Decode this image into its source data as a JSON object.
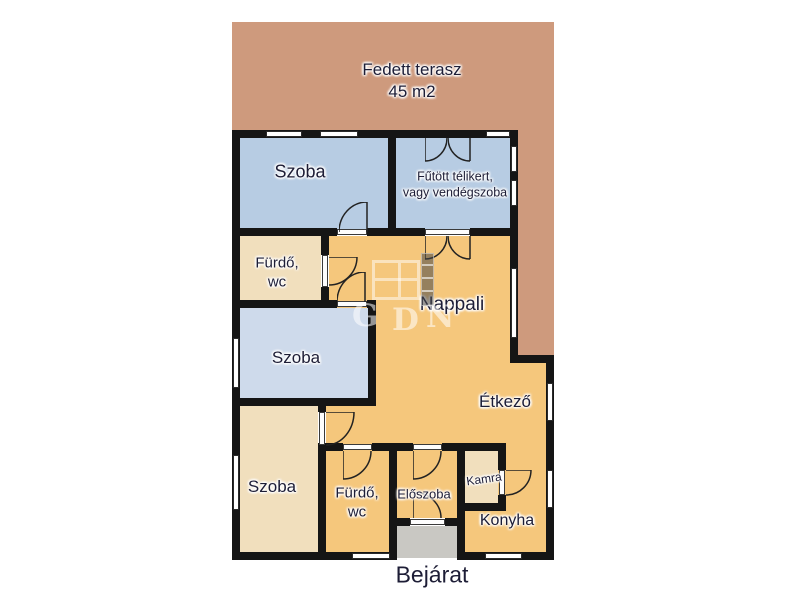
{
  "plan": {
    "type": "floorplan",
    "language": "hu",
    "entrance_label": "Bejárat",
    "terrace": {
      "label": "Fedett terasz",
      "area": "45 m2"
    },
    "rooms": [
      {
        "id": "szoba-top",
        "label": "Szoba"
      },
      {
        "id": "telikert",
        "label_line1": "Fűtött télikert,",
        "label_line2": "vagy vendégszoba"
      },
      {
        "id": "furdo-top",
        "label_line1": "Fürdő,",
        "label_line2": "wc"
      },
      {
        "id": "szoba-middle",
        "label": "Szoba"
      },
      {
        "id": "nappali",
        "label": "Nappali"
      },
      {
        "id": "etkezo",
        "label": "Étkező"
      },
      {
        "id": "szoba-bottom",
        "label": "Szoba"
      },
      {
        "id": "furdo-bottom",
        "label_line1": "Fürdő,",
        "label_line2": "wc"
      },
      {
        "id": "eloszoba",
        "label": "Előszoba"
      },
      {
        "id": "kamra",
        "label": "Kamra"
      },
      {
        "id": "konyha",
        "label": "Konyha"
      }
    ],
    "watermark": {
      "letters": [
        "G",
        "D",
        "N"
      ]
    },
    "palette": {
      "terrace": "#CE9A7D",
      "room_blue": "#B7CCE3",
      "room_blue_light": "#CEDAEB",
      "room_cream": "#F1DFBD",
      "room_orange": "#F5C77C",
      "doormat_gray": "#C9C8C3",
      "wall_black": "#151515",
      "label_text": "#1D1D36",
      "background": "#FFFFFF"
    }
  }
}
